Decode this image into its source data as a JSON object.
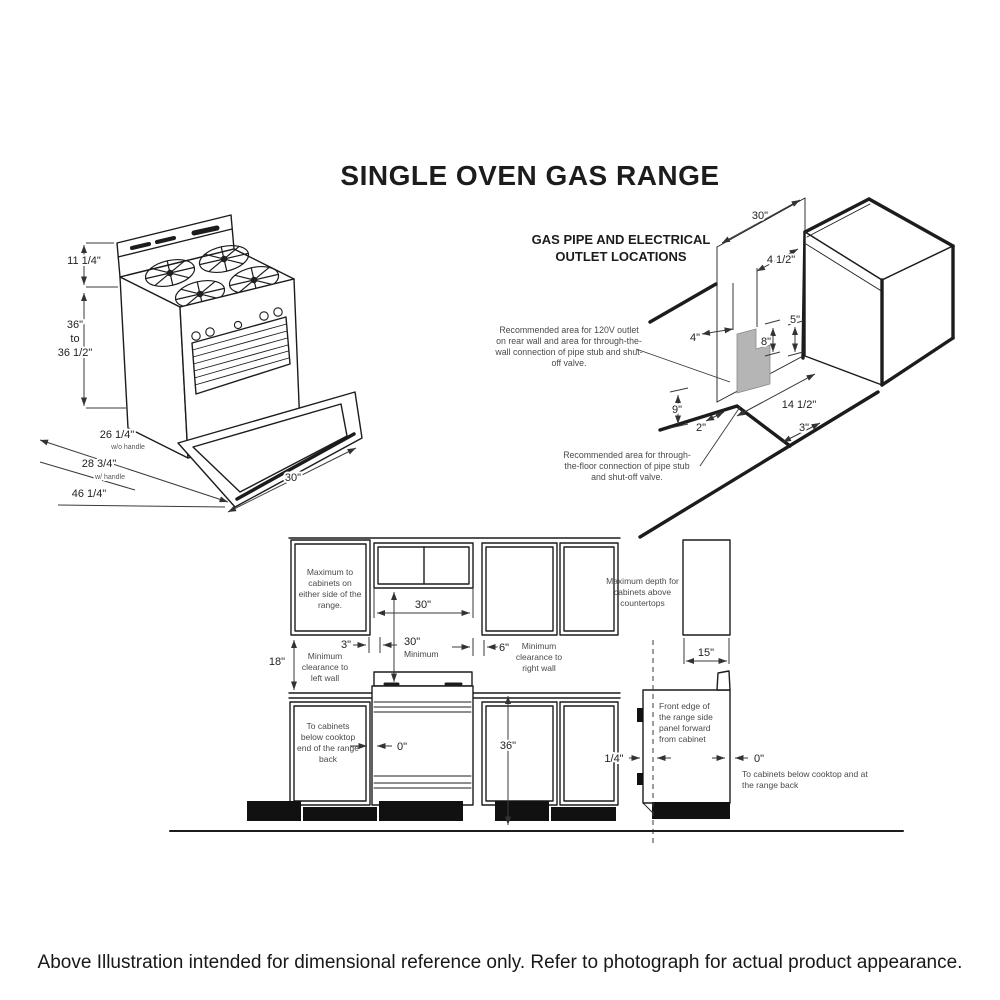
{
  "title": "SINGLE OVEN GAS RANGE",
  "colors": {
    "line": "#1c1c1c",
    "shaded_area": "#b5b5b5"
  },
  "range_iso": {
    "dim_backsplash": "11 1/4\"",
    "dim_height_1": "36\"",
    "dim_height_2": "to",
    "dim_height_3": "36 1/2\"",
    "dim_depth_no_handle": "26 1/4\"",
    "dim_depth_no_handle_note": "w/o handle",
    "dim_depth_handle": "28 3/4\"",
    "dim_depth_handle_note": "w/ handle",
    "dim_depth_door_open": "46 1/4\"",
    "dim_width": "30\""
  },
  "gas_diagram": {
    "heading_line1": "GAS PIPE AND ELECTRICAL",
    "heading_line2": "OUTLET LOCATIONS",
    "note_wall": "Recommended area for 120V outlet on rear wall and area for through-the-wall connection of pipe stub and shut-off valve.",
    "note_floor": "Recommended area for through-the-floor connection of pipe stub and shut-off valve.",
    "dim_wall_width": "30\"",
    "dim_4_5": "4 1/2\"",
    "dim_4": "4\"",
    "dim_5": "5\"",
    "dim_8": "8\"",
    "dim_9": "9\"",
    "dim_2": "2\"",
    "dim_14_5": "14 1/2\"",
    "dim_3": "3\""
  },
  "elevation": {
    "note_side_cabinets": "Maximum to cabinets on either side of the range.",
    "dim_width": "30\"",
    "dim_min": "30\"",
    "dim_min_label": "Minimum",
    "dim_3": "3\"",
    "dim_6": "6\"",
    "note_right_wall": "Minimum clearance to right wall",
    "dim_18": "18\"",
    "note_left_wall": "Minimum clearance to left wall",
    "note_below_left": "To cabinets below cooktop end of the range back",
    "dim_0": "0\"",
    "dim_36": "36\""
  },
  "side_view": {
    "note_depth": "Maximum depth for cabinets above countertops",
    "dim_15": "15\"",
    "note_front_edge": "Front edge of the range side panel forward from cabinet",
    "dim_quarter": "1/4\"",
    "dim_0": "0\"",
    "note_below_right": "To cabinets below cooktop and at the range back"
  },
  "footer": {
    "caption": "Above Illustration intended for dimensional reference only. Refer to photograph for actual product appearance."
  }
}
